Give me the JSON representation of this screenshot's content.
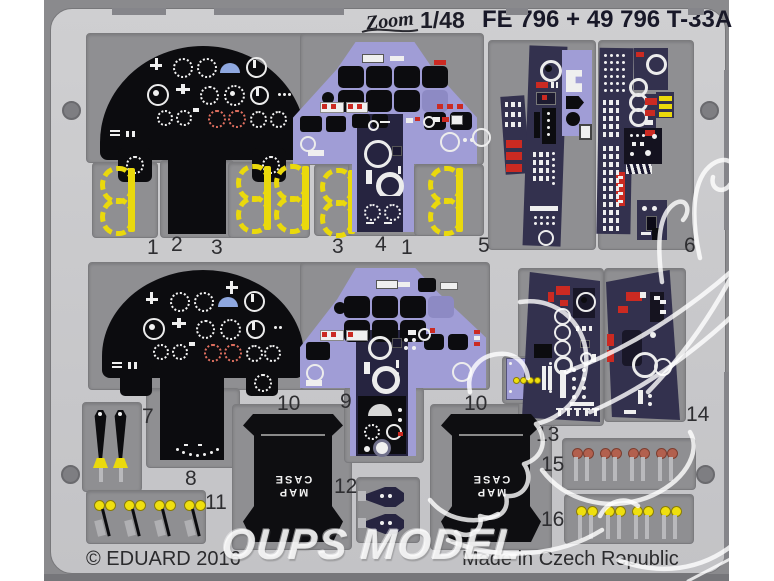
{
  "header": {
    "logo_text": "Zoom",
    "scale": "1/48",
    "title": "FE 796 + 49 796 T-33A"
  },
  "footer": {
    "copyright": "© EDUARD 2016",
    "made_in": "Made in Czech Republic"
  },
  "watermark": {
    "brand_text": "OUPS MODEL"
  },
  "map_case": {
    "line1": "MAP",
    "line2": "CASE"
  },
  "part_labels": [
    "1",
    "2",
    "3",
    "3",
    "4",
    "1",
    "5",
    "6",
    "7",
    "10",
    "9",
    "10",
    "14",
    "13",
    "8",
    "11",
    "12",
    "15",
    "16"
  ],
  "colors": {
    "photo_background": "#8a8a8d",
    "fret_metal": "#c7c7c9",
    "recess": "#8f8f92",
    "panel_black": "#0c0c0f",
    "panel_lavender": "#a09dd6",
    "console_navy": "#33314e",
    "detail_red": "#cb2a22",
    "detail_yellow": "#ead90c",
    "knob_brown": "#b2604e",
    "knob_yellow": "#efdf0e",
    "watermark_white": "#ffffff"
  }
}
